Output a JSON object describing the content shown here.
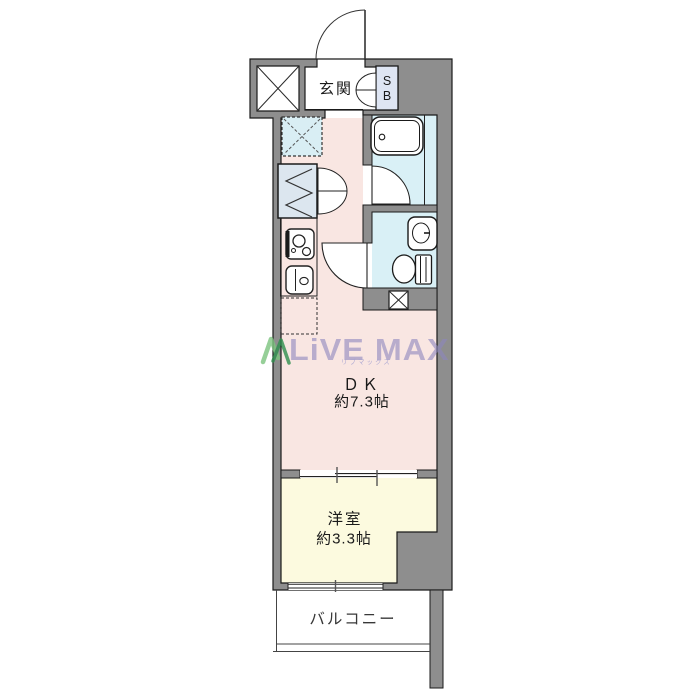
{
  "page": {
    "background": "#ffffff"
  },
  "floor_plan": {
    "rooms": {
      "entrance": {
        "label": "玄関"
      },
      "shoe_box": {
        "abbr_line1": "S",
        "abbr_line2": "B"
      },
      "dining_kitchen": {
        "label": "ＤＫ",
        "size": "約7.3帖"
      },
      "western_room": {
        "label": "洋室",
        "size": "約3.3帖"
      },
      "balcony": {
        "label": "バルコニー"
      }
    },
    "fixtures": [
      "bathtub",
      "toilet",
      "washbasin",
      "kitchen-stove",
      "kitchen-sink",
      "closet",
      "washing-machine-space",
      "refrigerator-space",
      "elevator-shaft",
      "pipe-space",
      "entrance-door",
      "bath-door",
      "toilet-door",
      "sliding-partition",
      "window"
    ],
    "colors": {
      "wall": "#8e8e8e",
      "outline": "#1a1a1a",
      "dk_floor": "#f9e6e2",
      "western_floor": "#fcfadf",
      "wet_area_floor": "#d9f0f6",
      "closet_fill": "#dce6ef",
      "shoe_box_fill": "#dee5f3"
    }
  },
  "watermark": {
    "brand": "LiVE MAX",
    "kana": "リブマックス",
    "text_color": "#8d87bf",
    "logo_green_light": "#7cc47f",
    "logo_green_dark": "#2f8f4e"
  }
}
